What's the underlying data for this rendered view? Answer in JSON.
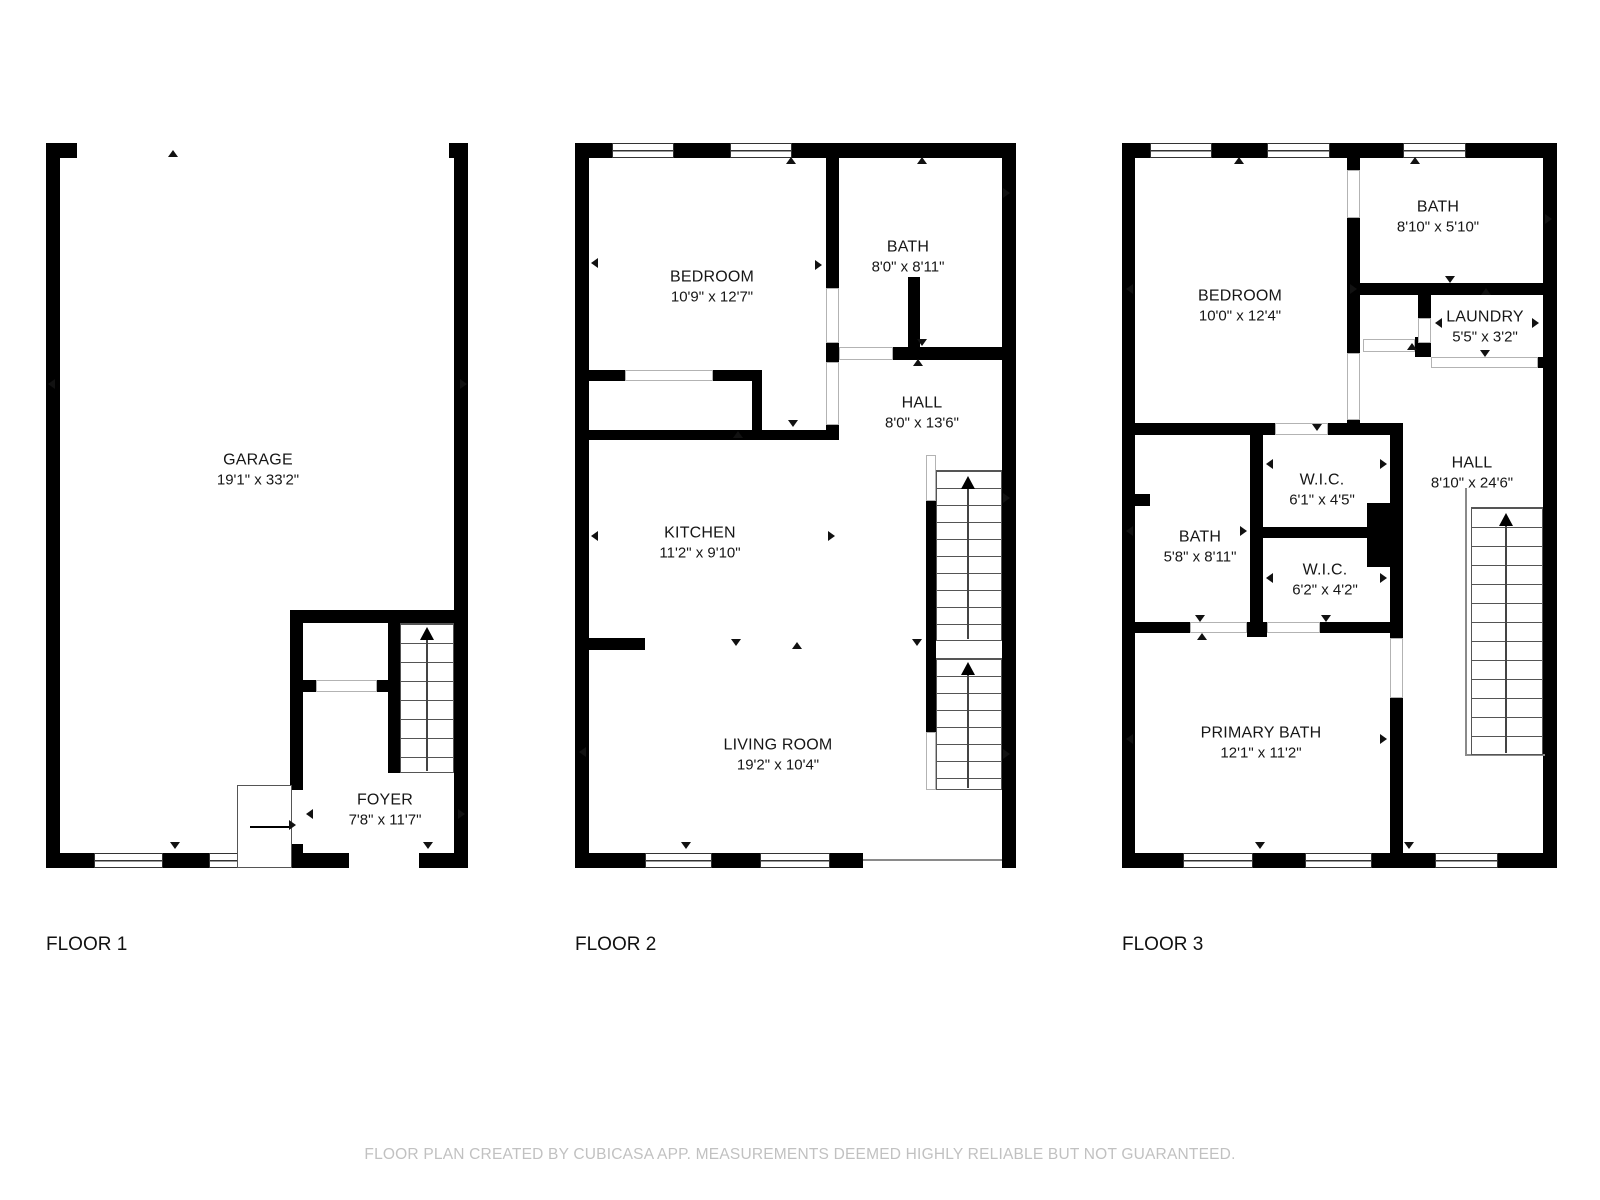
{
  "footer": {
    "disclaimer": "FLOOR PLAN CREATED BY CUBICASA APP. MEASUREMENTS DEEMED HIGHLY RELIABLE BUT NOT GUARANTEED."
  },
  "floors": [
    {
      "label": "FLOOR 1",
      "rooms": [
        {
          "name": "GARAGE",
          "dims": "19'1\" x 33'2\""
        },
        {
          "name": "FOYER",
          "dims": "7'8\" x 11'7\""
        }
      ]
    },
    {
      "label": "FLOOR 2",
      "rooms": [
        {
          "name": "BEDROOM",
          "dims": "10'9\" x 12'7\""
        },
        {
          "name": "BATH",
          "dims": "8'0\" x 8'11\""
        },
        {
          "name": "HALL",
          "dims": "8'0\" x 13'6\""
        },
        {
          "name": "KITCHEN",
          "dims": "11'2\" x 9'10\""
        },
        {
          "name": "LIVING ROOM",
          "dims": "19'2\" x 10'4\""
        }
      ]
    },
    {
      "label": "FLOOR 3",
      "rooms": [
        {
          "name": "BEDROOM",
          "dims": "10'0\" x 12'4\""
        },
        {
          "name": "BATH",
          "dims": "8'10\" x 5'10\""
        },
        {
          "name": "LAUNDRY",
          "dims": "5'5\" x 3'2\""
        },
        {
          "name": "W.I.C.",
          "dims": "6'1\" x 4'5\""
        },
        {
          "name": "BATH",
          "dims": "5'8\" x 8'11\""
        },
        {
          "name": "W.I.C.",
          "dims": "6'2\" x 4'2\""
        },
        {
          "name": "HALL",
          "dims": "8'10\" x 24'6\""
        },
        {
          "name": "PRIMARY BATH",
          "dims": "12'1\" x 11'2\""
        }
      ]
    }
  ]
}
